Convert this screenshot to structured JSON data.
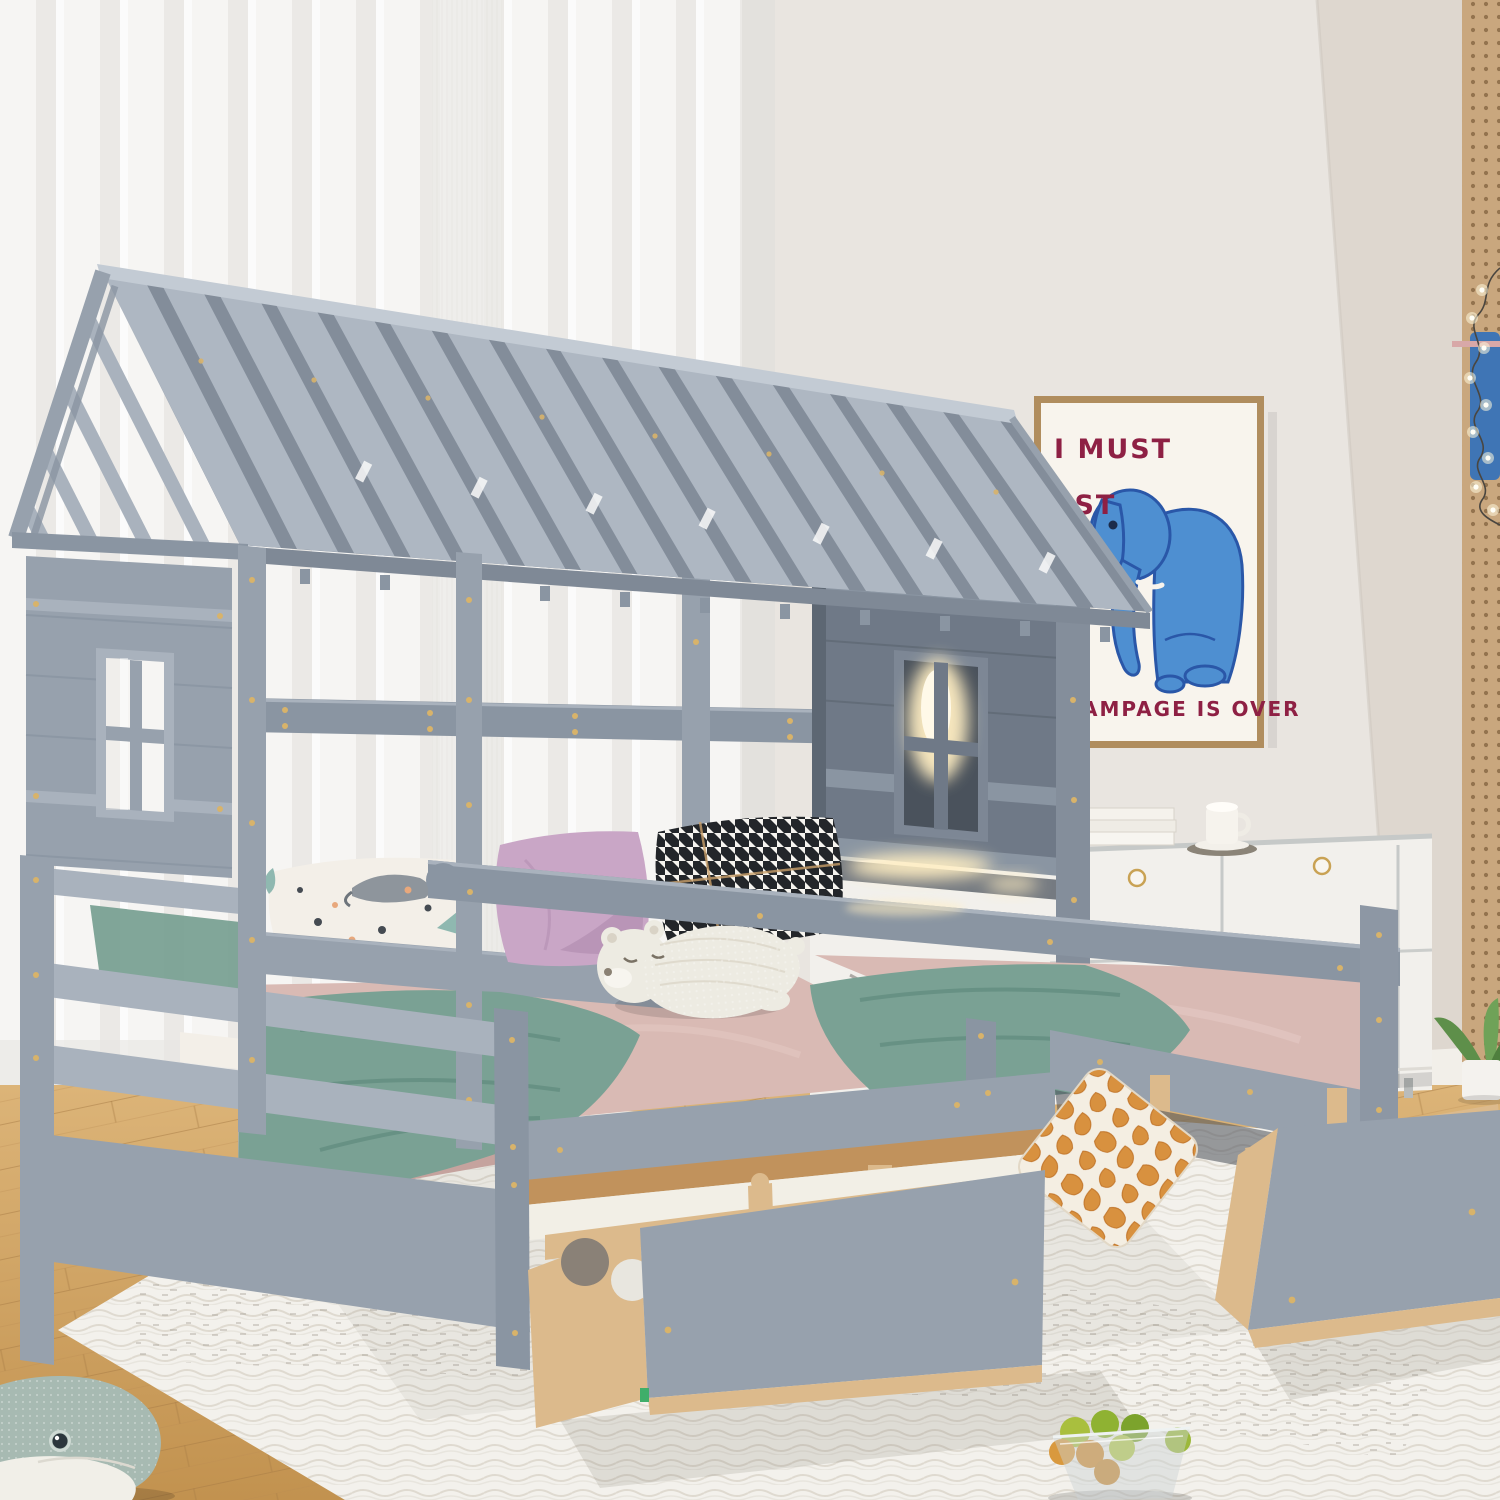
{
  "poster": {
    "line1": "I MUST",
    "line2": "EST",
    "line3": "AMPAGE IS OVER"
  },
  "colors": {
    "wall": "#e9e5e0",
    "wallRight": "#ded7cf",
    "curtain": "#f6f5f3",
    "curtainShade": "#e7e5e1",
    "pegboard": "#c9a77e",
    "pegHole": "#8a6a45",
    "posterBg": "#f8f4ed",
    "posterFrame": "#b08d5e",
    "posterText": "#8e2044",
    "elephantBlue": "#4e8fd1",
    "elephantLine": "#2a57a8",
    "baseboard": "#f2efe9",
    "floorHi": "#dcb478",
    "floorLo": "#c2924f",
    "rug": "#f3f1ec",
    "rugLine": "#ddd8cd",
    "cabinet": "#f2f0ec",
    "chrome": "#c6c9c8",
    "knobGold": "#c9a254",
    "grayL": "#a9b2bd",
    "grayBase": "#97a1ad",
    "grayMid": "#8a95a2",
    "grayDark": "#6f7987",
    "grayDeep": "#5d6773",
    "roofPlank": "#aeb7c2",
    "roofHi": "#c3cbd4",
    "screw": "#d8b36a",
    "mattress": "#d9bab4",
    "mattressShade": "#c5a39e",
    "blanket": "#7aa194",
    "blanketDark": "#5f8a7e",
    "pillowWhite": "#f3efe8",
    "pillowLilac": "#c9a6c6",
    "lilacShade": "#b28fb0",
    "woodNat": "#dcba8c",
    "woodDark": "#c1925c",
    "giraffeOrange": "#d8913f",
    "bearCream": "#edebe2",
    "whaleTeal": "#a7bab2",
    "whaleBelly": "#f1efe8",
    "ledGlow": "#ffeec2",
    "plantGreen": "#5e8f4a",
    "fruitLime": "#a9bf3e",
    "fruitOrange": "#d9993e",
    "toyBlue": "#3f75b5"
  }
}
